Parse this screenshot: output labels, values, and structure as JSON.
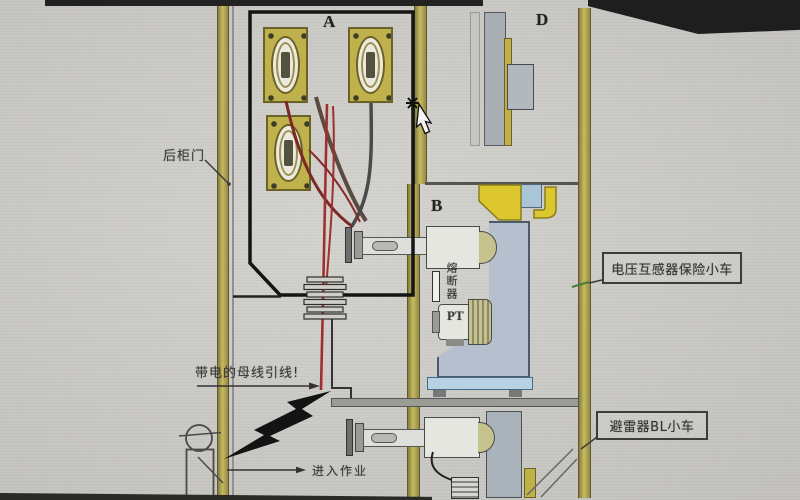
{
  "diagram": {
    "compartments": {
      "a": "A",
      "b": "B",
      "d": "D"
    },
    "annotations": {
      "rear_door": "后柜门",
      "live_busbar": "带电的母线引线!",
      "enter_work": "进入作业",
      "fuse": "熔断器",
      "pt": "PT"
    },
    "callouts": {
      "vt_trolley": "电压互感器保险小车",
      "arrester_trolley": "避雷器BL小车"
    }
  },
  "colors": {
    "frame_yellow": "#c2b85e",
    "busbar_yellow": "#dcc72e",
    "panel_blue_gray": "#b6bfce",
    "base_light_blue": "#b7d2e2",
    "cable_red": "#a03030",
    "paper": "#d6d5d0"
  }
}
